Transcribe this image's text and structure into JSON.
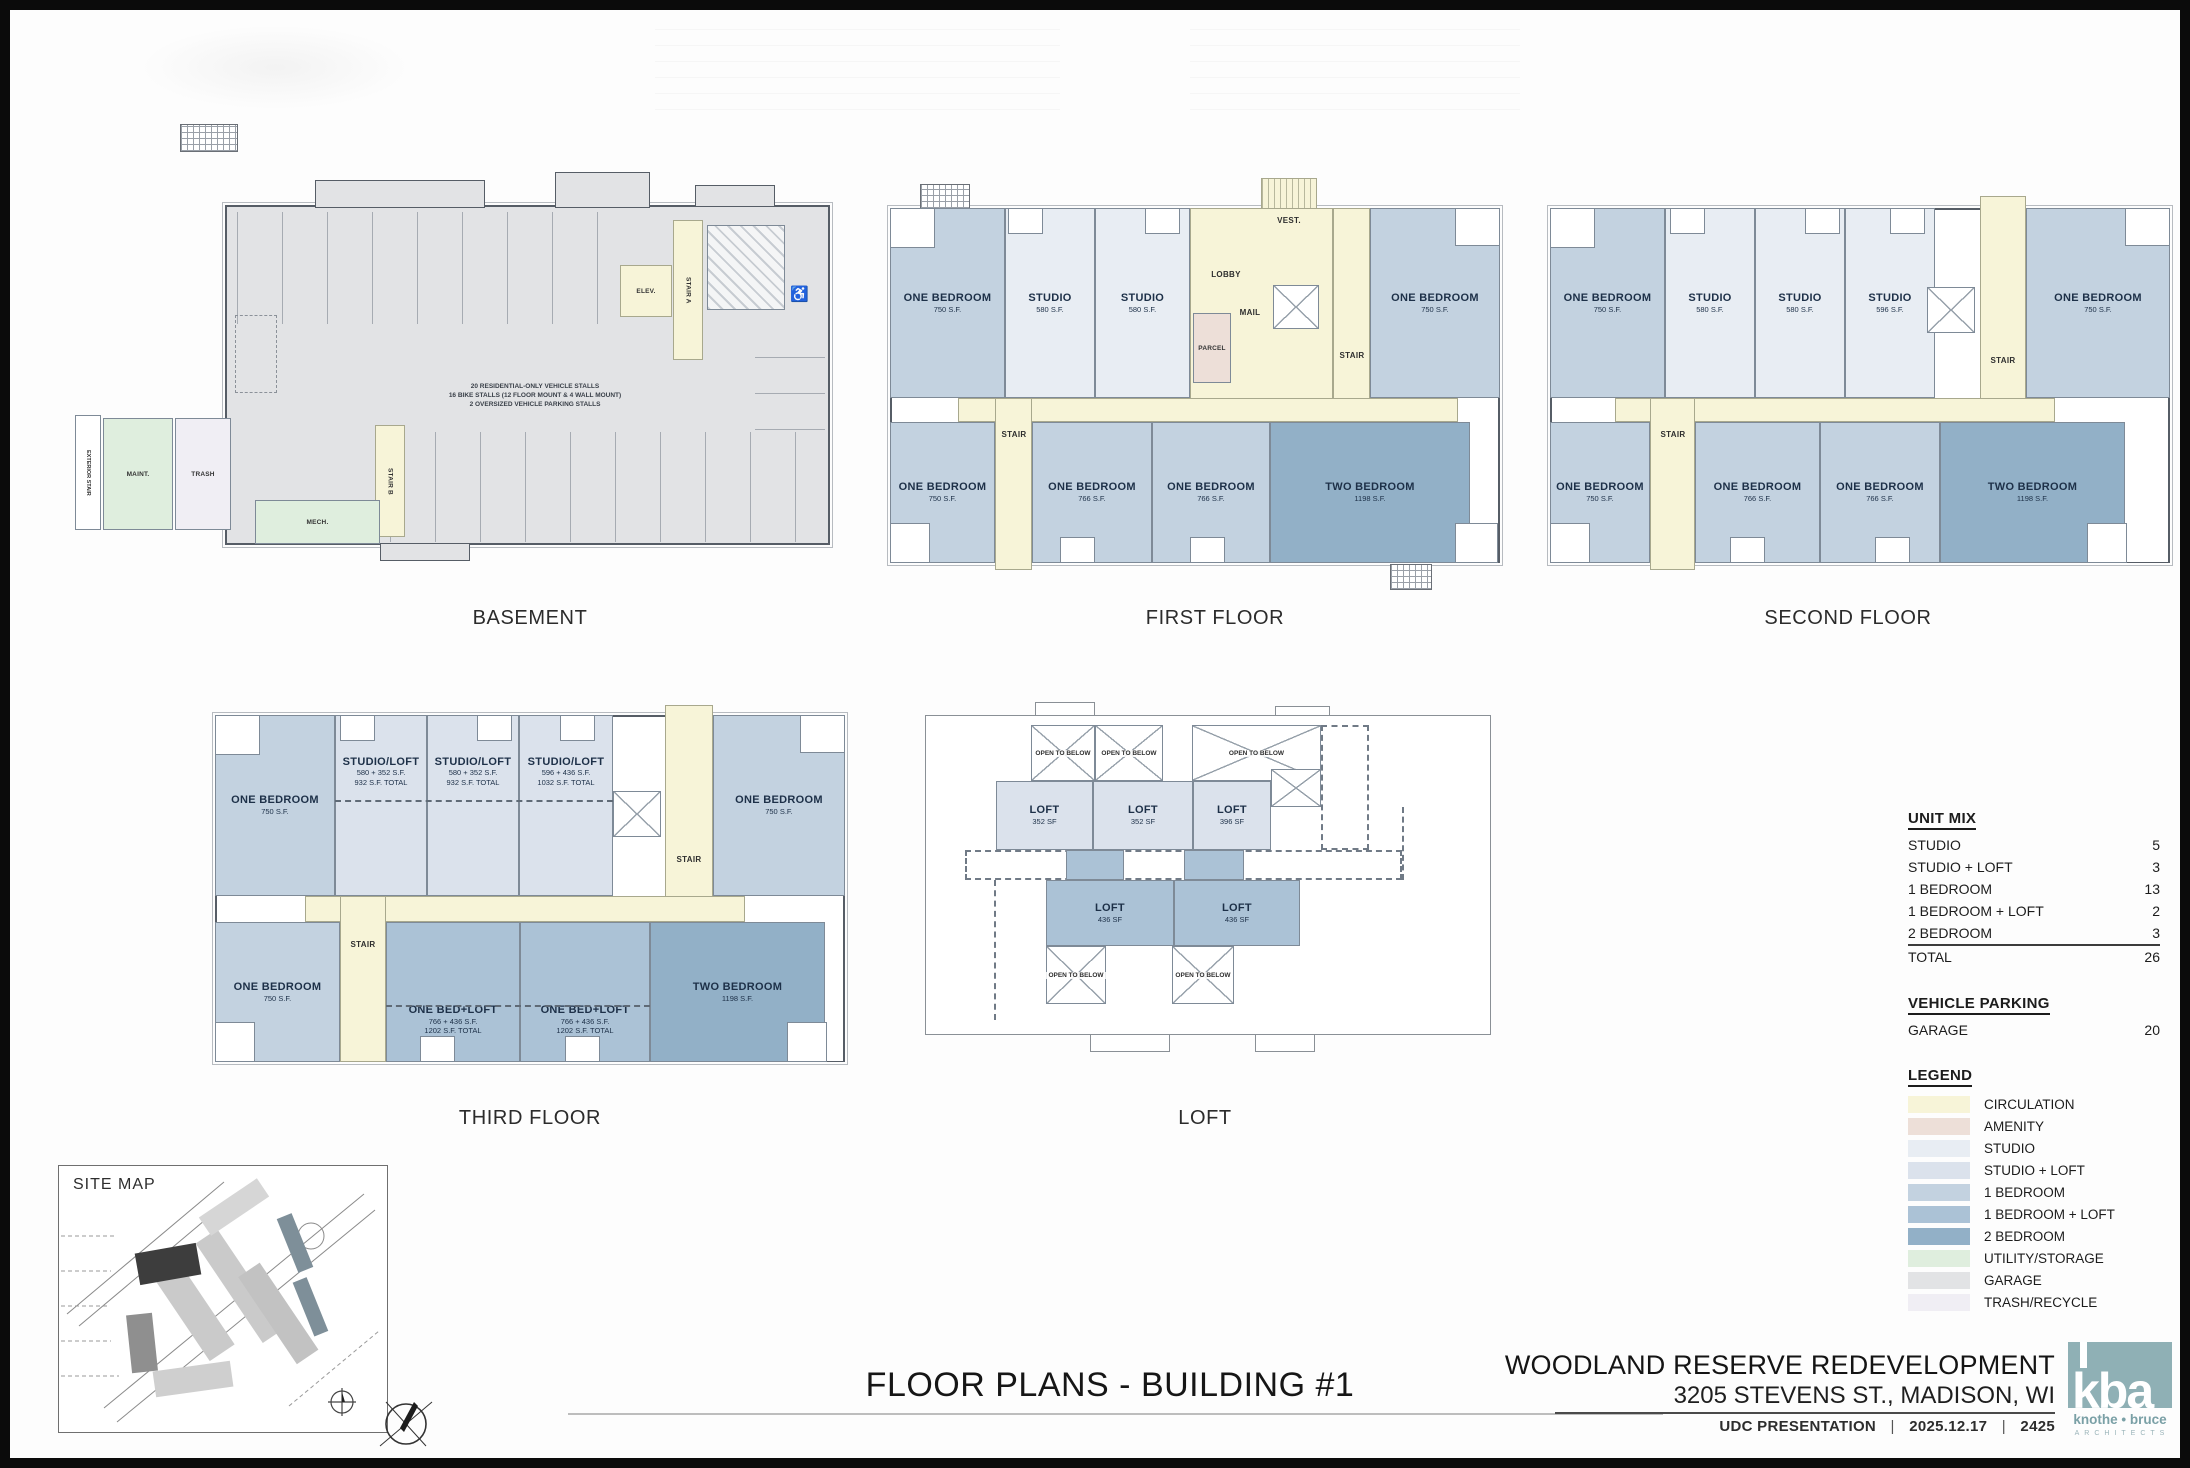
{
  "page": {
    "title": "FLOOR PLANS - BUILDING #1",
    "project": {
      "name": "WOODLAND RESERVE REDEVELOPMENT",
      "address": "3205 STEVENS ST., MADISON, WI",
      "presentation": "UDC PRESENTATION",
      "date": "2025.12.17",
      "number": "2425",
      "sep": "|"
    },
    "logo": {
      "letters": "kba",
      "firm": "knothe • bruce",
      "sub": "ARCHITECTS"
    }
  },
  "site_map": {
    "label": "SITE MAP"
  },
  "unit_mix": {
    "title": "UNIT MIX",
    "rows": [
      {
        "label": "STUDIO",
        "value": "5"
      },
      {
        "label": "STUDIO + LOFT",
        "value": "3"
      },
      {
        "label": "1 BEDROOM",
        "value": "13"
      },
      {
        "label": "1 BEDROOM + LOFT",
        "value": "2"
      },
      {
        "label": "2 BEDROOM",
        "value": "3"
      }
    ],
    "total_label": "TOTAL",
    "total_value": "26"
  },
  "vehicle_parking": {
    "title": "VEHICLE PARKING",
    "rows": [
      {
        "label": "GARAGE",
        "value": "20"
      }
    ]
  },
  "legend": {
    "title": "LEGEND",
    "items": [
      {
        "label": "CIRCULATION",
        "color": "#f7f4d8"
      },
      {
        "label": "AMENITY",
        "color": "#eddfd8"
      },
      {
        "label": "STUDIO",
        "color": "#e8edf3"
      },
      {
        "label": "STUDIO + LOFT",
        "color": "#dbe2ec"
      },
      {
        "label": "1 BEDROOM",
        "color": "#c3d2e0"
      },
      {
        "label": "1 BEDROOM + LOFT",
        "color": "#abc2d6"
      },
      {
        "label": "2 BEDROOM",
        "color": "#92b0c7"
      },
      {
        "label": "UTILITY/STORAGE",
        "color": "#dfeede"
      },
      {
        "label": "GARAGE",
        "color": "#e2e3e5"
      },
      {
        "label": "TRASH/RECYCLE",
        "color": "#f0eef4"
      }
    ]
  },
  "floors": {
    "basement": {
      "title": "BASEMENT",
      "note1": "20 RESIDENTIAL-ONLY VEHICLE STALLS",
      "note2": "16 BIKE STALLS (12 FLOOR MOUNT & 4 WALL MOUNT)",
      "note3": "2 OVERSIZED VEHICLE PARKING STALLS",
      "rooms": {
        "elev": "ELEV.",
        "stair_a": "STAIR A",
        "stair_b": "STAIR B",
        "maint": "MAINT.",
        "trash": "TRASH",
        "mech": "MECH.",
        "exterior_stair": "EXTERIOR STAIR"
      },
      "accessible_icon": "♿"
    },
    "first": {
      "title": "FIRST FLOOR",
      "units": [
        {
          "name": "ONE BEDROOM",
          "sf": "750 S.F."
        },
        {
          "name": "STUDIO",
          "sf": "580 S.F."
        },
        {
          "name": "STUDIO",
          "sf": "580 S.F."
        },
        {
          "name": "ONE BEDROOM",
          "sf": "750 S.F."
        },
        {
          "name": "ONE BEDROOM",
          "sf": "750 S.F."
        },
        {
          "name": "ONE BEDROOM",
          "sf": "766 S.F."
        },
        {
          "name": "ONE BEDROOM",
          "sf": "766 S.F."
        },
        {
          "name": "TWO BEDROOM",
          "sf": "1198 S.F."
        }
      ],
      "rooms": {
        "lobby": "LOBBY",
        "vest": "VEST.",
        "mail": "MAIL",
        "parcel": "PARCEL",
        "stair_top": "STAIR",
        "stair_bottom": "STAIR"
      }
    },
    "second": {
      "title": "SECOND FLOOR",
      "units": [
        {
          "name": "ONE BEDROOM",
          "sf": "750 S.F."
        },
        {
          "name": "STUDIO",
          "sf": "580 S.F."
        },
        {
          "name": "STUDIO",
          "sf": "580 S.F."
        },
        {
          "name": "STUDIO",
          "sf": "596 S.F."
        },
        {
          "name": "ONE BEDROOM",
          "sf": "750 S.F."
        },
        {
          "name": "ONE BEDROOM",
          "sf": "750 S.F."
        },
        {
          "name": "ONE BEDROOM",
          "sf": "766 S.F."
        },
        {
          "name": "ONE BEDROOM",
          "sf": "766 S.F."
        },
        {
          "name": "TWO BEDROOM",
          "sf": "1198 S.F."
        }
      ],
      "rooms": {
        "stair_top": "STAIR",
        "stair_bottom": "STAIR"
      }
    },
    "third": {
      "title": "THIRD FLOOR",
      "units": [
        {
          "name": "ONE BEDROOM",
          "sf": "750 S.F."
        },
        {
          "name": "STUDIO/LOFT",
          "sf": "580 + 352 S.F.",
          "total": "932 S.F. TOTAL"
        },
        {
          "name": "STUDIO/LOFT",
          "sf": "580 + 352 S.F.",
          "total": "932 S.F. TOTAL"
        },
        {
          "name": "STUDIO/LOFT",
          "sf": "596 + 436 S.F.",
          "total": "1032 S.F. TOTAL"
        },
        {
          "name": "ONE BEDROOM",
          "sf": "750 S.F."
        },
        {
          "name": "ONE BEDROOM",
          "sf": "750 S.F."
        },
        {
          "name": "ONE BED+LOFT",
          "sf": "766 + 436 S.F.",
          "total": "1202 S.F. TOTAL"
        },
        {
          "name": "ONE BED+LOFT",
          "sf": "766 + 436 S.F.",
          "total": "1202 S.F. TOTAL"
        },
        {
          "name": "TWO BEDROOM",
          "sf": "1198 S.F."
        }
      ],
      "rooms": {
        "stair_top": "STAIR",
        "stair_bottom": "STAIR"
      }
    },
    "loft": {
      "title": "LOFT",
      "open_below": "OPEN TO BELOW",
      "units": [
        {
          "name": "LOFT",
          "sf": "352 SF"
        },
        {
          "name": "LOFT",
          "sf": "352 SF"
        },
        {
          "name": "LOFT",
          "sf": "396 SF"
        },
        {
          "name": "LOFT",
          "sf": "436 SF"
        },
        {
          "name": "LOFT",
          "sf": "436 SF"
        }
      ]
    }
  }
}
